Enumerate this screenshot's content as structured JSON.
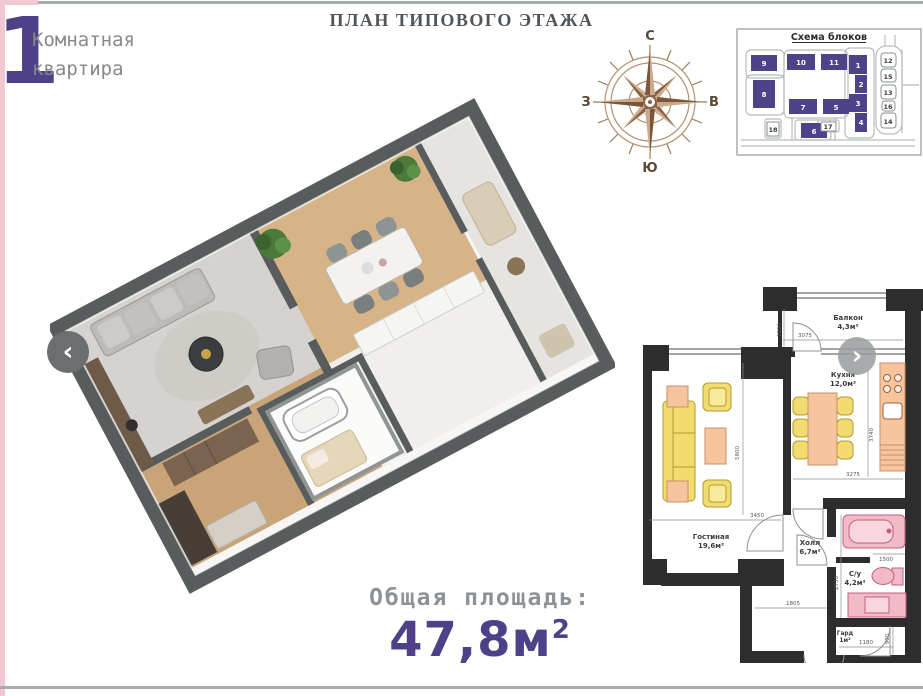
{
  "page": {
    "background": "#ffffff",
    "accent_purple": "#4e4187",
    "accent_pink": "#f1c7d1",
    "line_gray": "#a6abae",
    "plan_wall_color": "#2d2d2d",
    "furniture_yellow": "#f3dc6f",
    "furniture_peach": "#f6c49d",
    "fixture_pink": "#f2b9c7"
  },
  "header": {
    "apartment_number": "1",
    "apartment_type_line1": "Комнатная",
    "apartment_type_line2": "квартира",
    "title": "ПЛАН ТИПОВОГО ЭТАЖА"
  },
  "compass": {
    "north": "С",
    "south": "Ю",
    "west": "З",
    "east": "В"
  },
  "block_scheme": {
    "title": "Схема блоков",
    "blocks_filled": [
      "9",
      "10",
      "11",
      "8",
      "7",
      "5",
      "1",
      "2",
      "3",
      "4",
      "6"
    ],
    "blocks_outline": [
      "18",
      "17",
      "12",
      "15",
      "13",
      "16",
      "14"
    ]
  },
  "floor_plan_2d": {
    "rooms": [
      {
        "name": "Балкон",
        "area": "4,3м²"
      },
      {
        "name": "Кухня",
        "area": "12,0м²"
      },
      {
        "name": "Гостиная",
        "area": "19,6м²"
      },
      {
        "name": "Холл",
        "area": "6,7м²"
      },
      {
        "name": "С/у",
        "area": "4,2м²"
      },
      {
        "name": "Гард",
        "area": "1м²"
      }
    ],
    "dimensions": [
      "1250",
      "3075",
      "3740",
      "3275",
      "3450",
      "5800",
      "1805",
      "1500",
      "2730",
      "1180",
      "900"
    ]
  },
  "total_area": {
    "label": "Общая площадь:",
    "value": "47,8",
    "unit": "м",
    "sup": "2"
  },
  "navigation": {
    "prev_label": "‹",
    "next_label": "›",
    "prev_icon": "chevron-left-icon",
    "next_icon": "chevron-right-icon"
  }
}
